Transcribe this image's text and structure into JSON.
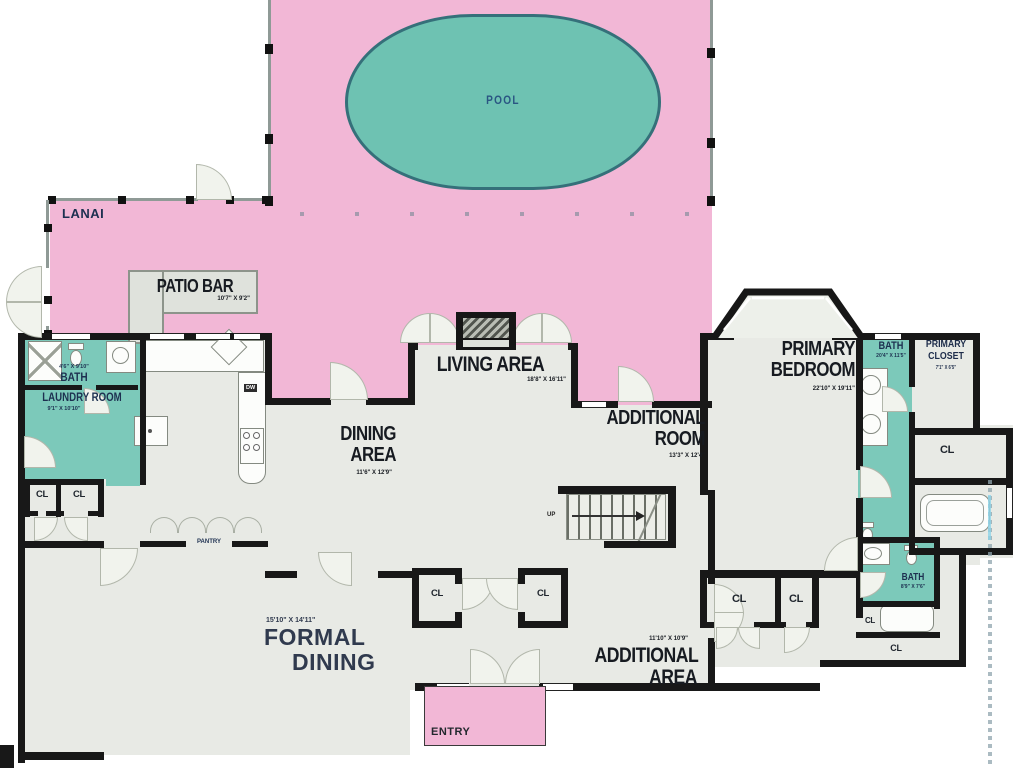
{
  "colors": {
    "outdoor_pink": "#f2b7d6",
    "pool_teal": "#6ec2b2",
    "room_teal": "#7cc9ba",
    "interior_gray": "#e8eae5",
    "wall_black": "#181818",
    "label_navy": "#1d3050",
    "label_dark": "#171b21"
  },
  "rooms": {
    "pool": {
      "label": "POOL"
    },
    "lanai": {
      "label": "LANAI"
    },
    "patio_bar": {
      "label": "PATIO BAR",
      "dims": "10'7\" X 9'2\""
    },
    "bath1": {
      "label": "BATH",
      "dims": "4'6\" X 9'10\""
    },
    "laundry": {
      "label": "LAUNDRY ROOM",
      "dims": "9'1\" X 10'10\""
    },
    "dining": {
      "line1": "DINING",
      "line2": "AREA",
      "dims": "11'6\" X 12'9\""
    },
    "living": {
      "label": "LIVING AREA",
      "dims": "18'8\" X 16'11\""
    },
    "additional_room": {
      "line1": "ADDITIONAL",
      "line2": "ROOM",
      "dims": "13'3\" X 12'4\""
    },
    "primary_bedroom": {
      "line1": "PRIMARY",
      "line2": "BEDROOM",
      "dims": "22'10\" X 19'11\""
    },
    "primary_bath": {
      "label": "BATH",
      "dims": "20'4\" X 11'5\""
    },
    "primary_closet": {
      "line1": "PRIMARY",
      "line2": "CLOSET",
      "dims": "7'1\" X 6'5\""
    },
    "bath2": {
      "label": "BATH",
      "dims": "8'9\" X 7'6\""
    },
    "formal_dining": {
      "line1": "FORMAL",
      "line2": "DINING",
      "dims": "15'10\" X 14'11\""
    },
    "additional_area": {
      "line1": "ADDITIONAL",
      "line2": "AREA",
      "dims": "11'10\" X 10'9\""
    },
    "entry": {
      "label": "ENTRY"
    },
    "pantry": {
      "label": "PANTRY"
    }
  },
  "annotations": {
    "up": "UP",
    "closet": "CL",
    "dishwasher": "DW"
  }
}
